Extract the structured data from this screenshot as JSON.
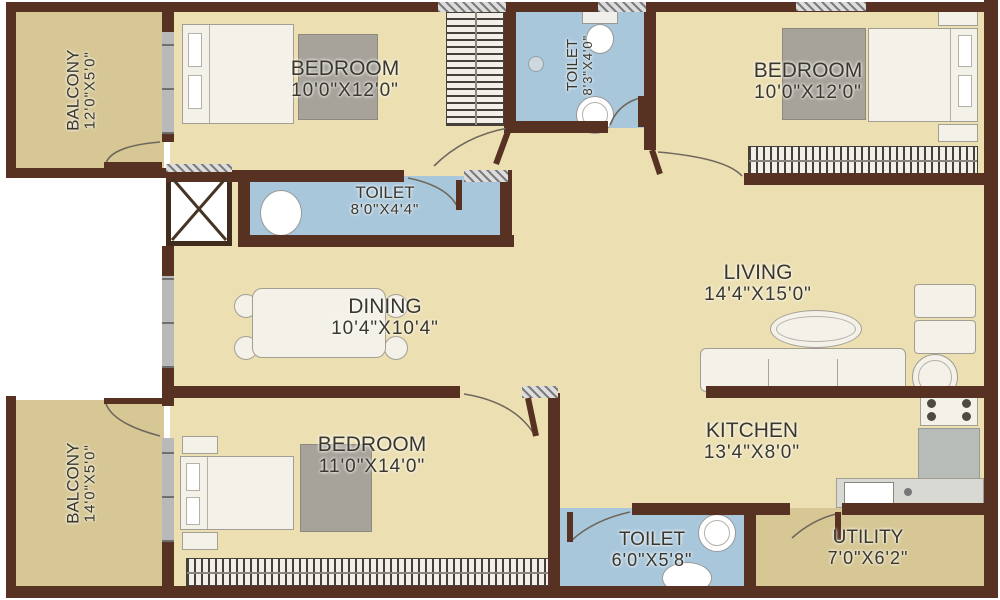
{
  "plan": {
    "type": "apartment-floor-plan",
    "colors": {
      "floor": "#ecdfb2",
      "balcony_floor": "#d6c795",
      "toilet_floor": "#a9c7db",
      "wall": "#573122",
      "window": "#b9b9b9",
      "text": "#3a372c",
      "furniture_fill": "#f4f1e9",
      "furniture_outline": "#a39e94",
      "rug": "#a7a39b",
      "counter": "#b8bcb8"
    },
    "rooms": [
      {
        "id": "balcony-top-left",
        "name": "BALCONY",
        "dims": "12'0\"X5'0\"",
        "label_orientation": "vertical"
      },
      {
        "id": "bedroom-top-left",
        "name": "BEDROOM",
        "dims": "10'0\"X12'0\"",
        "label_orientation": "horizontal"
      },
      {
        "id": "toilet-top",
        "name": "TOILET",
        "dims": "8'3\"X4'0\"",
        "label_orientation": "vertical"
      },
      {
        "id": "bedroom-top-right",
        "name": "BEDROOM",
        "dims": "10'0\"X12'0\"",
        "label_orientation": "horizontal"
      },
      {
        "id": "toilet-middle",
        "name": "TOILET",
        "dims": "8'0\"X4'4\"",
        "label_orientation": "horizontal"
      },
      {
        "id": "dining",
        "name": "DINING",
        "dims": "10'4\"X10'4\"",
        "label_orientation": "horizontal"
      },
      {
        "id": "living",
        "name": "LIVING",
        "dims": "14'4\"X15'0\"",
        "label_orientation": "horizontal"
      },
      {
        "id": "balcony-bottom-left",
        "name": "BALCONY",
        "dims": "14'0\"X5'0\"",
        "label_orientation": "vertical"
      },
      {
        "id": "bedroom-bottom",
        "name": "BEDROOM",
        "dims": "11'0\"X14'0\"",
        "label_orientation": "horizontal"
      },
      {
        "id": "kitchen",
        "name": "KITCHEN",
        "dims": "13'4\"X8'0\"",
        "label_orientation": "horizontal"
      },
      {
        "id": "toilet-bottom",
        "name": "TOILET",
        "dims": "6'0\"X5'8\"",
        "label_orientation": "horizontal"
      },
      {
        "id": "utility",
        "name": "UTILITY",
        "dims": "7'0\"X6'2\"",
        "label_orientation": "horizontal"
      }
    ],
    "furniture_icons": [
      "double-bed",
      "pillow",
      "rug",
      "wardrobe",
      "dining-table",
      "dining-chair",
      "sofa",
      "coffee-table",
      "armchair",
      "round-side-table",
      "stove-hob",
      "kitchen-counter",
      "kitchen-sink",
      "wash-basin",
      "water-closet",
      "shower-head",
      "duct-shaft-cross",
      "door-swing-arc",
      "window-hatch"
    ]
  }
}
